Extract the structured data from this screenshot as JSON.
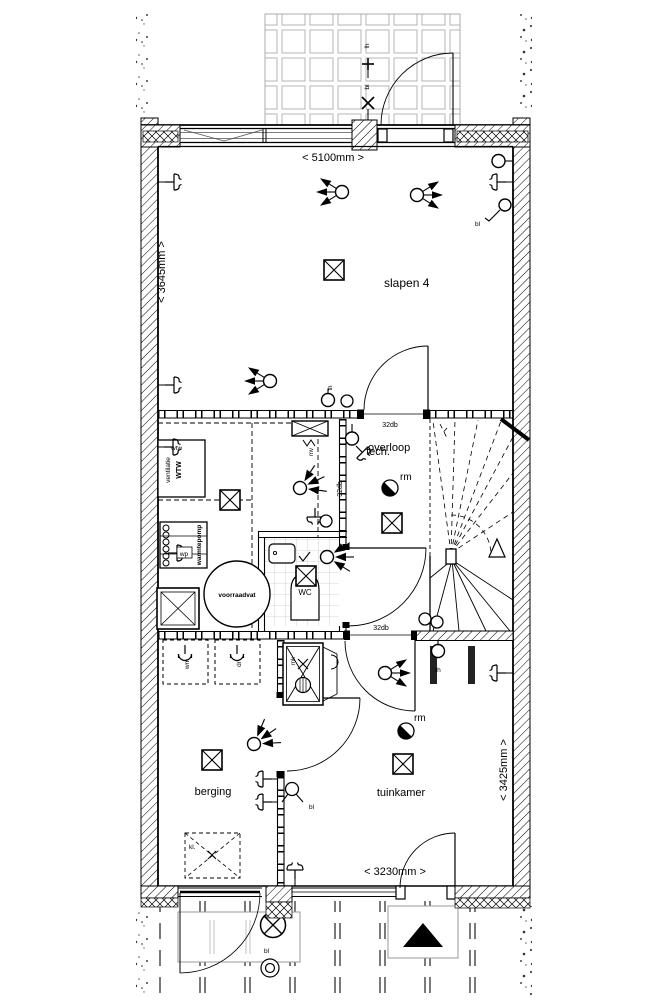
{
  "ink": "#000000",
  "tile_grid_color": "#b5b5b5",
  "labels": {
    "room_slapen4": "slapen 4",
    "room_tech": "tech.",
    "room_overloop": "overloop",
    "room_wc": "WC",
    "room_berging": "berging",
    "room_tuinkamer": "tuinkamer",
    "dim_top": "< 5100mm >",
    "dim_left": "< 3645mm >",
    "dim_right": "< 3425mm >",
    "dim_bottom": "< 3230mm >",
    "db_top": "32db",
    "db_mid": "32db",
    "db_bottom": "32db",
    "ventilatie": "ventilatie",
    "wtw_unit": "WTW",
    "wtw_switch": "wtw",
    "warmtepomp": "warmtepomp",
    "wp": "wp",
    "voorraadvat": "voorraadvat",
    "mv": "mv",
    "mk": "mk",
    "wm": "wm",
    "dr": "dr",
    "kl": "kl.",
    "rm_overloop": "rm",
    "rm_tuinkamer": "rm",
    "th_slapen": "th",
    "th_tuinkamer": "th",
    "lh_balkon": "lh",
    "bl_balkon": "bl",
    "bl_slapen": "bl",
    "bl_berging": "bl",
    "bl_buiten": "bl"
  }
}
